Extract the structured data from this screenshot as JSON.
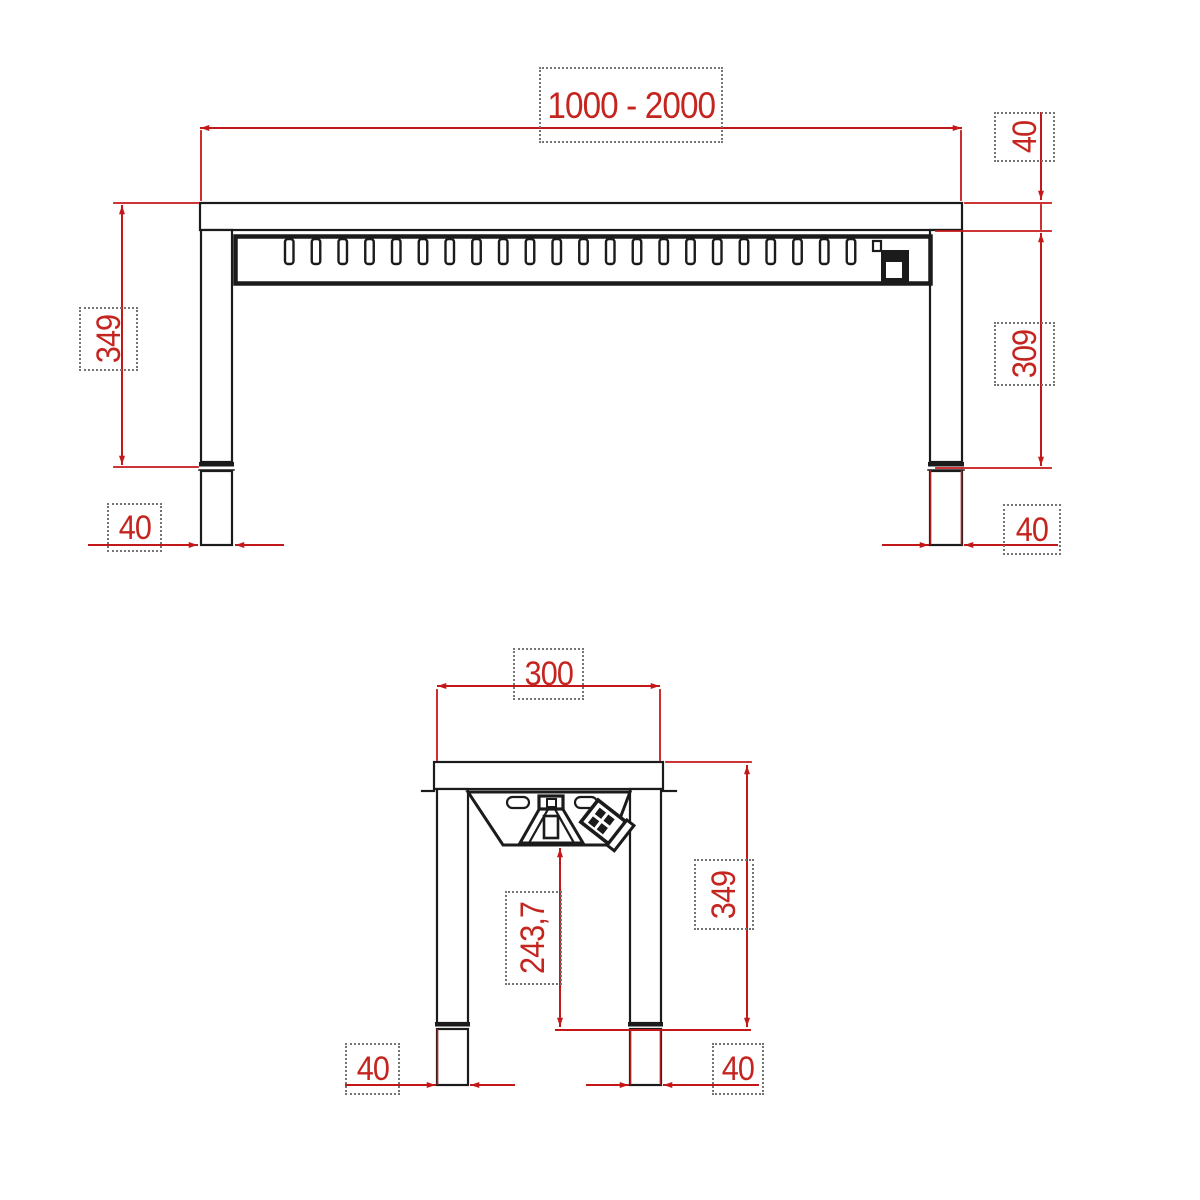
{
  "colors": {
    "outline": "#1b1b1b",
    "dimension_lines": "#c41718",
    "dimension_text": "#c4251f",
    "dashed_frame": "#747474",
    "background": "#ffffff"
  },
  "front_view": {
    "vent_slot_count": 22,
    "dimensions": {
      "width": "1000 - 2000",
      "top_thickness": "40",
      "overall_height": "349",
      "under_top_height": "309",
      "left_leg_width": "40",
      "right_leg_width": "40"
    }
  },
  "side_view": {
    "dimensions": {
      "depth": "300",
      "overall_height": "349",
      "underside_clearance": "243,7",
      "left_leg_width": "40",
      "right_leg_width": "40"
    }
  }
}
